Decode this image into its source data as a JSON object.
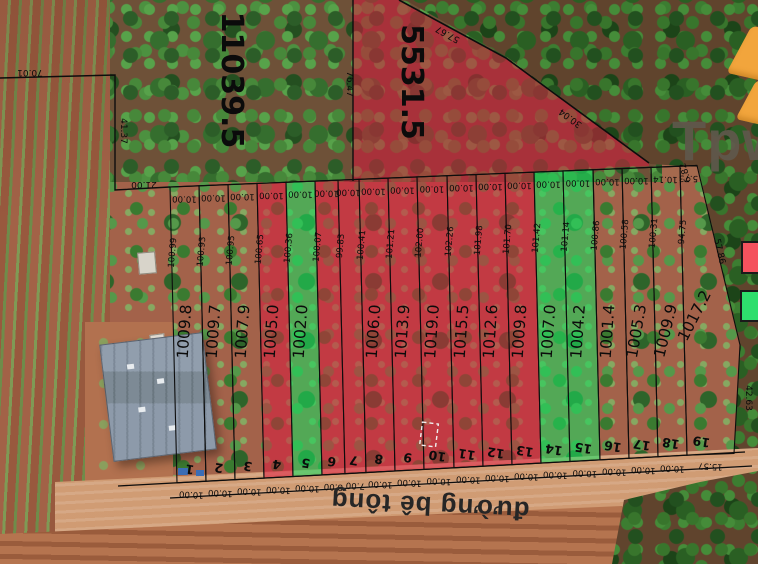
{
  "map": {
    "road_label": "đường bê tông",
    "watermark_text": "Tpw",
    "colors": {
      "line": "#0d0d0d",
      "label": "#0b0b0b",
      "red_overlay": "rgba(222,22,62,0.52)",
      "green_overlay": "rgba(25,218,95,0.58)",
      "legend_red": "#f4525e",
      "legend_green": "#2ede6d",
      "logo_orange": "#f2a53c"
    },
    "legend": [
      {
        "name": "red-highlight-swatch",
        "swatch": "legend_red"
      },
      {
        "name": "green-highlight-swatch",
        "swatch": "legend_green"
      }
    ]
  },
  "survey": {
    "top_line": {
      "x0": 170,
      "y0": 187,
      "x1": 697,
      "y1": 165.5
    },
    "road_line": {
      "x0": 118,
      "y0": 486,
      "x1": 745,
      "y1": 452
    },
    "plot19_edge": [
      [
        697,
        165.5
      ],
      [
        740,
        345
      ],
      [
        734,
        453.5
      ]
    ],
    "boundary_lines": [
      {
        "pts": [
          [
            0,
            78
          ],
          [
            115,
            75
          ],
          [
            115,
            190
          ],
          [
            170,
            187
          ]
        ],
        "w": 1.4
      },
      {
        "pts": [
          [
            353,
            0
          ],
          [
            353,
            181
          ]
        ],
        "w": 1.4
      },
      {
        "pts": [
          [
            399,
            0
          ],
          [
            506,
            58
          ],
          [
            649,
            163
          ]
        ],
        "w": 1.6
      },
      {
        "pts": [
          [
            170,
            187
          ],
          [
            697,
            165.5
          ]
        ],
        "w": 1.2
      },
      {
        "pts": [
          [
            118,
            486
          ],
          [
            745,
            452
          ]
        ],
        "w": 1.3
      },
      {
        "pts": [
          [
            170,
            498
          ],
          [
            752,
            466
          ]
        ],
        "w": 1.3
      }
    ],
    "dashed_rect": {
      "x": 421,
      "y": 423,
      "w": 16,
      "h": 23,
      "rot": 7
    }
  },
  "big_plots": [
    {
      "area": "11039.5",
      "x": 222,
      "y": 80,
      "rot": 90
    },
    {
      "area": "5531.5",
      "x": 402,
      "y": 82,
      "rot": 90
    }
  ],
  "plots": [
    {
      "n": "1",
      "area": "1009.8",
      "shade": null,
      "top_w": "10.00",
      "bottom_w": "10.00",
      "side_len": "100.99",
      "x0": 170,
      "x1": 199
    },
    {
      "n": "2",
      "area": "1009.7",
      "shade": null,
      "top_w": "10.00",
      "bottom_w": "10.00",
      "side_len": "100.93",
      "x0": 199,
      "x1": 228
    },
    {
      "n": "3",
      "area": "1007.9",
      "shade": null,
      "top_w": "10.00",
      "bottom_w": "10.00",
      "side_len": "100.95",
      "x0": 228,
      "x1": 257
    },
    {
      "n": "4",
      "area": "1005.0",
      "shade": "red",
      "top_w": "10.00",
      "bottom_w": "10.00",
      "side_len": "100.65",
      "x0": 257,
      "x1": 286
    },
    {
      "n": "5",
      "area": "1002.0",
      "shade": "green",
      "top_w": "10.00",
      "bottom_w": "10.00",
      "side_len": "100.36",
      "x0": 286,
      "x1": 315
    },
    {
      "n": "6",
      "area": "",
      "shade": "red",
      "top_w": "10.00",
      "bottom_w": "8.00",
      "side_len": "100.07",
      "x0": 315,
      "x1": 338
    },
    {
      "n": "7",
      "area": "",
      "shade": "red",
      "top_w": "10.00",
      "bottom_w": "7.00",
      "side_len": "99.83",
      "x0": 338,
      "x1": 359
    },
    {
      "n": "8",
      "area": "1006.0",
      "shade": "red",
      "top_w": "10.00",
      "bottom_w": "10.00",
      "side_len": "100.41",
      "x0": 359,
      "x1": 388
    },
    {
      "n": "9",
      "area": "1013.9",
      "shade": "red",
      "top_w": "10.00",
      "bottom_w": "10.00",
      "side_len": "101.21",
      "x0": 388,
      "x1": 417
    },
    {
      "n": "10",
      "area": "1019.0",
      "shade": "red",
      "top_w": "10.00",
      "bottom_w": "10.00",
      "side_len": "102.00",
      "x0": 417,
      "x1": 447
    },
    {
      "n": "11",
      "area": "1015.5",
      "shade": "red",
      "top_w": "10.00",
      "bottom_w": "10.00",
      "side_len": "102.26",
      "x0": 447,
      "x1": 476
    },
    {
      "n": "12",
      "area": "1012.6",
      "shade": "red",
      "top_w": "10.00",
      "bottom_w": "10.00",
      "side_len": "101.98",
      "x0": 476,
      "x1": 505
    },
    {
      "n": "13",
      "area": "1009.8",
      "shade": "red",
      "top_w": "10.00",
      "bottom_w": "10.00",
      "side_len": "101.70",
      "x0": 505,
      "x1": 534
    },
    {
      "n": "14",
      "area": "1007.0",
      "shade": "green",
      "top_w": "10.00",
      "bottom_w": "10.00",
      "side_len": "101.42",
      "x0": 534,
      "x1": 563
    },
    {
      "n": "15",
      "area": "1004.2",
      "shade": "green",
      "top_w": "10.00",
      "bottom_w": "10.00",
      "side_len": "101.14",
      "x0": 563,
      "x1": 593
    },
    {
      "n": "16",
      "area": "1001.4",
      "shade": null,
      "top_w": "10.00",
      "bottom_w": "10.00",
      "side_len": "100.86",
      "x0": 593,
      "x1": 622
    },
    {
      "n": "17",
      "area": "1005.3",
      "shade": null,
      "top_w": "10.00",
      "bottom_w": "10.00",
      "side_len": "100.58",
      "x0": 622,
      "x1": 651,
      "label_rot": -80
    },
    {
      "n": "18",
      "area": "1009.9",
      "shade": null,
      "top_w": "10.14",
      "bottom_w": "10.00",
      "side_len": "100.31",
      "x0": 651,
      "x1": 680,
      "label_rot": -76
    },
    {
      "n": "19",
      "area": "1017.2",
      "shade": null,
      "top_w": "5.73",
      "bottom_w": "15.57",
      "side_len": "94.75",
      "x0": 680,
      "x1": 697,
      "label_rot": -63,
      "label_x": 699,
      "label_y": 318,
      "num_x": 702
    }
  ],
  "edge_dims": [
    {
      "text": "70.01",
      "x": 30,
      "y": 70,
      "rot": 180
    },
    {
      "text": "41.37",
      "x": 121,
      "y": 131,
      "rot": 90
    },
    {
      "text": "21.00",
      "x": 144,
      "y": 182,
      "rot": 180
    },
    {
      "text": "76.47",
      "x": 347,
      "y": 84,
      "rot": 90
    },
    {
      "text": "57.67",
      "x": 449,
      "y": 32,
      "rot": 209
    },
    {
      "text": "30.04",
      "x": 572,
      "y": 116,
      "rot": 216
    },
    {
      "text": "6.82",
      "x": 688,
      "y": 172,
      "rot": 252
    },
    {
      "text": "57.86",
      "x": 717,
      "y": 252,
      "rot": 77
    },
    {
      "text": "42.63",
      "x": 746,
      "y": 398,
      "rot": 90
    }
  ]
}
